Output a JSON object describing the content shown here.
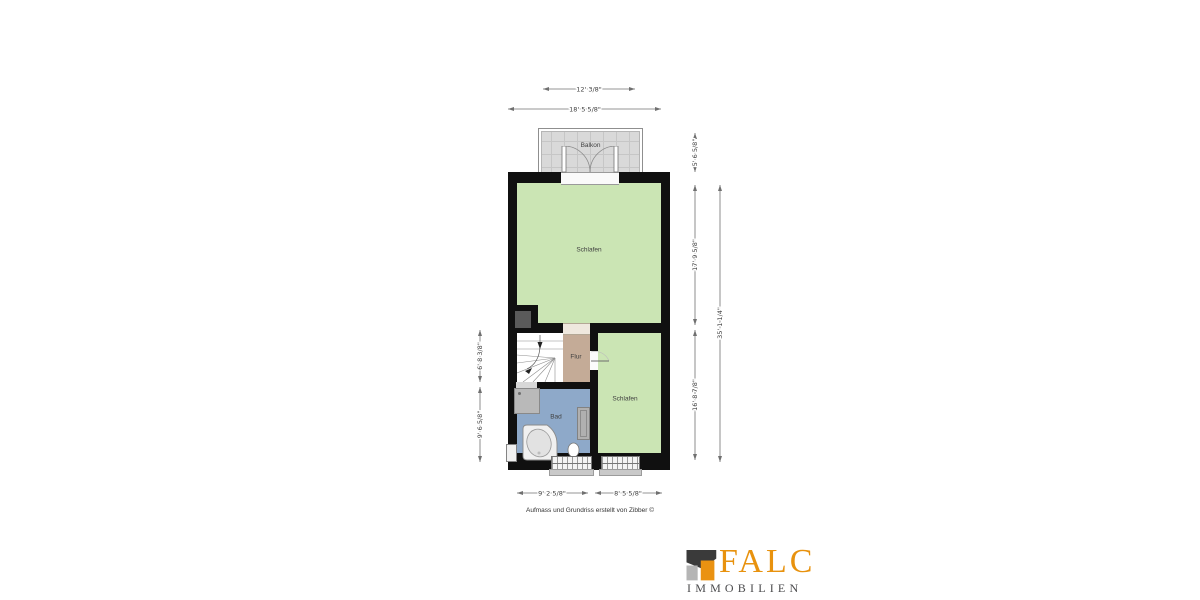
{
  "plan": {
    "rooms": {
      "balkon": "Balkon",
      "bedroom_main": "Schlafen",
      "hall": "Flur",
      "bath": "Bad",
      "bedroom_second": "Schlafen"
    },
    "dimensions": {
      "top_inner": "12' 3/8\"",
      "top_outer": "18' 5 5/8\"",
      "right_balcony": "5' 6 5/8\"",
      "right_upper": "17' 9 5/8\"",
      "right_lower": "16' 8 7/8\"",
      "right_total": "35' 1 1/4\"",
      "left_upper": "6' 8 3/8\"",
      "left_lower": "9' 6 5/8\"",
      "bottom_left": "9' 2 5/8\"",
      "bottom_right": "8' 5 5/8\""
    },
    "footer_note": "Aufmass und Grundriss erstellt von Zibber ©",
    "colors": {
      "room_green": "#cbe5b4",
      "hall_tan": "#c4ab97",
      "bath_blue": "#8ea9c9",
      "balcony_gray": "#d9d9d9",
      "wall_black": "#101010"
    }
  },
  "logo": {
    "brand": "FALC",
    "subtitle": "IMMOBILIEN",
    "brand_color": "#e8920e",
    "subtitle_color": "#4a4a4c",
    "mark_dark": "#3a3a3a",
    "mark_gray": "#b5b5b5",
    "mark_orange": "#ea9211"
  }
}
